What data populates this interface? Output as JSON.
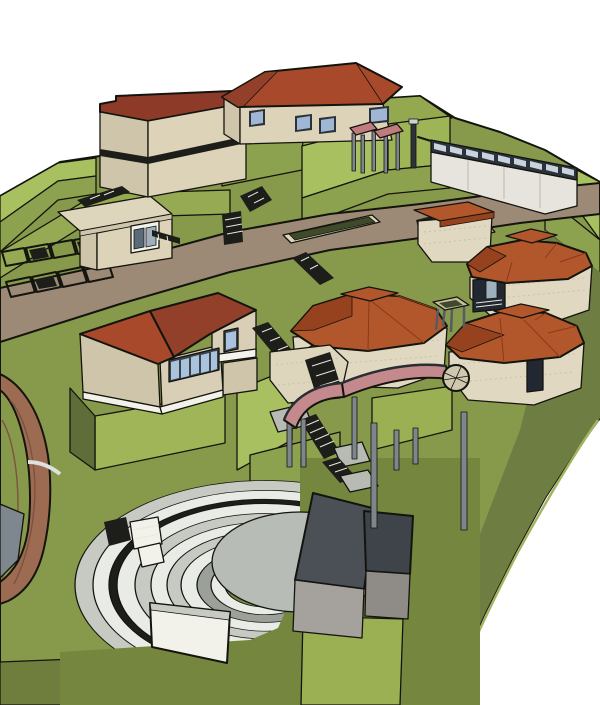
{
  "scene": {
    "description": "SketchUp-style 3D render of a terraced hillside campus site model",
    "objects": [
      {
        "id": "terrain",
        "label": "Stepped green terraces and slopes"
      },
      {
        "id": "main-road",
        "label": "Curved access road crossing the site"
      },
      {
        "id": "parking-lot",
        "label": "Marked parking stalls with parked cars"
      },
      {
        "id": "gatehouse",
        "label": "Small gatehouse with window"
      },
      {
        "id": "office-building",
        "label": "Multi-story tan building with flat dark-red roof"
      },
      {
        "id": "classroom-building",
        "label": "Single-story building with red hip roof and blue windows"
      },
      {
        "id": "pergola-walkway",
        "label": "Pink canopy pergola on gray posts"
      },
      {
        "id": "clerestory-hall",
        "label": "Long white hall with clerestory window band"
      },
      {
        "id": "stone-pavilion",
        "label": "Octagonal stone pavilions with tiered terracotta roofs (x4)"
      },
      {
        "id": "table-canopy",
        "label": "Small square canopy table on posts"
      },
      {
        "id": "balcony-house",
        "label": "Two-story house with red roof, window strip and balcony"
      },
      {
        "id": "switchback-stairs",
        "label": "Zigzag hillside stairs with landings"
      },
      {
        "id": "stone-underpass",
        "label": "Stone box with stair ramp"
      },
      {
        "id": "elevated-walkway",
        "label": "Curved pink elevated walkway on piers with wheel window"
      },
      {
        "id": "amphitheater",
        "label": "Open-air amphitheater with curved seating rows"
      },
      {
        "id": "stage-circle",
        "label": "Circular gray stage platform"
      },
      {
        "id": "projection-screen",
        "label": "White curved screen wall"
      },
      {
        "id": "stage-boxes",
        "label": "Dark gray backstage box buildings"
      },
      {
        "id": "brick-track",
        "label": "Curved brick band road at left edge"
      }
    ]
  },
  "palette": {
    "skyWhite": "#ffffff",
    "groundUpper": "#87994b",
    "groundLower": "#75863f",
    "terraceBright": "#a9c061",
    "terraceLight": "#9db457",
    "terraceMid": "#8da24e",
    "terraceTop": "#93a84f",
    "terraceLime": "#9fb558",
    "terraceLime2": "#9ab052",
    "terraceDark": "#6e7d41",
    "terraceDarker": "#5f6e38",
    "cornerGreen": "#6f7e3d",
    "parkingStrip": "#96aa53",
    "roadTan": "#9d8a76",
    "plazaTan": "#b09a80",
    "roofDarkRed": "#8e3a28",
    "roofRed": "#a8492c",
    "roofRedDark": "#93402a",
    "roofTerracotta": "#b2562c",
    "roofTerracottaDark": "#96421f",
    "wallTan": "#ddd3b8",
    "wallTanShade": "#cfc5aa",
    "wallCream": "#d9cfb6",
    "stoneWall": "#e0d8c0",
    "stoneLight": "#ddd5bc",
    "stoneShade": "#cfc7ae",
    "whitePaint": "#f2f1ea",
    "hallWhite": "#e6e4dd",
    "windowBlue": "#9fb6d4",
    "windowSky": "#aac3dd",
    "paneLight": "#c9d3dd",
    "frameDark": "#2b323a",
    "frameMid": "#3a4148",
    "glassDim": "#5a6a78",
    "glassPale": "#9fb0bd",
    "glassDark": "#222831",
    "darkLine": "#14140e",
    "postGray": "#7d868d",
    "postDark": "#2c3238",
    "capGray": "#cfd3d6",
    "deckPink": "#c4898c",
    "canopyPink": "#c07b7f",
    "seatWhite": "#e9ebe6",
    "seatGray": "#c6cac3",
    "seatDark": "#9ba099",
    "shadowBlack": "#1d1d19",
    "stageGray": "#b8bcb6",
    "landingGray": "#b7bbb3",
    "boxTopDark": "#4b5056",
    "boxTopDark2": "#3f444a",
    "boxFrontGray": "#a5a19d",
    "boxFrontGray2": "#8f8b87",
    "brickBrown": "#9c6b51",
    "brickLine": "#7c5340",
    "grayRoad": "#7e868e",
    "tableTop": "#c8bf9e",
    "planterGreen": "#3e4a2a",
    "railWhite": "#f4f3ee",
    "edgeLime": "#a3b45e"
  }
}
